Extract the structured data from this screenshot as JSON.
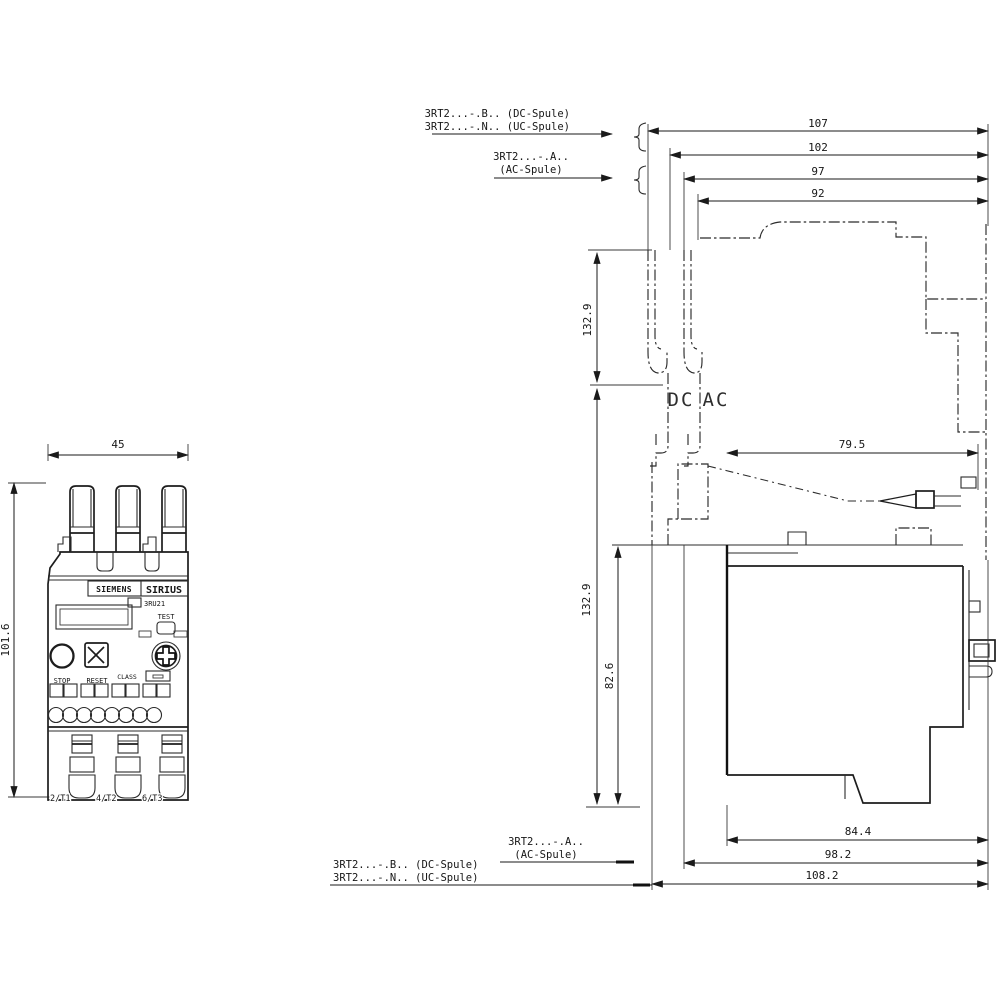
{
  "front_view": {
    "width_dim": "45",
    "height_dim": "101.6",
    "brand": "SIEMENS",
    "series": "SIRIUS",
    "model": "3RU21",
    "stop_label": "STOP",
    "reset_label": "RESET",
    "test_label": "TEST",
    "class_label": "CLASS",
    "terminals": [
      "2/T1",
      "4/T2",
      "6/T3"
    ]
  },
  "side_view": {
    "top_dims": [
      "107",
      "102",
      "97",
      "92"
    ],
    "depth_dim": "79.5",
    "left_dims": {
      "upper": "132.9",
      "lower": "132.9",
      "inner": "82.6"
    },
    "bottom_dims": [
      "84.4",
      "98.2",
      "108.2"
    ],
    "coil_dc": "DC",
    "coil_ac": "AC"
  },
  "leaders": {
    "top_dc": "3RT2...-.B.. (DC-Spule)",
    "top_uc": "3RT2...-.N.. (UC-Spule)",
    "top_ac_1": "3RT2...-.A..",
    "top_ac_2": "(AC-Spule)",
    "bottom_ac_1": "3RT2...-.A..",
    "bottom_ac_2": "(AC-Spule)",
    "bottom_dc": "3RT2...-.B.. (DC-Spule)",
    "bottom_uc": "3RT2...-.N.. (UC-Spule)"
  }
}
